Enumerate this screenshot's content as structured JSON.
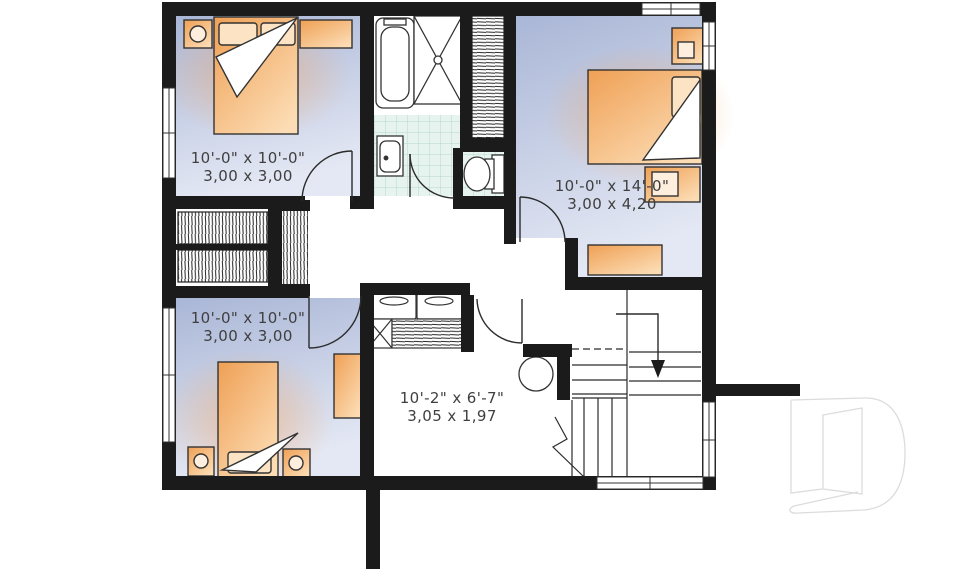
{
  "floor_plan": {
    "rooms": [
      {
        "id": "bedroom_top_left",
        "imperial": "10'-0\" x 10'-0\"",
        "metric": "3,00 x 3,00"
      },
      {
        "id": "bedroom_top_right",
        "imperial": "10'-0\" x 14'-0\"",
        "metric": "3,00 x 4,20"
      },
      {
        "id": "bedroom_bottom_left",
        "imperial": "10'-0\" x 10'-0\"",
        "metric": "3,00 x 3,00"
      },
      {
        "id": "hall",
        "imperial": "10'-2\" x 6'-7\"",
        "metric": "3,05 x 1,97"
      }
    ],
    "fixtures": [
      "double-bed",
      "single-bed",
      "nightstand",
      "dresser",
      "closet-shelves",
      "closet-doors",
      "linen-closet",
      "bathtub",
      "shower",
      "vanity-sink",
      "toilet",
      "washer",
      "dryer",
      "stairs",
      "water-heater-or-column"
    ],
    "stairs_direction": "down",
    "watermark_letter": "D",
    "colors": {
      "wall": "#1b1b1b",
      "room_top": "#a9b6d6",
      "room_bottom": "#e4e8f4",
      "furniture_dark": "#efa055",
      "furniture_light": "#fcdcb4",
      "tile_bg": "#e7f3ee",
      "tile_line": "#b7d8cd",
      "label_text": "#3f3f3f",
      "watermark": "#dcdcdc"
    }
  }
}
